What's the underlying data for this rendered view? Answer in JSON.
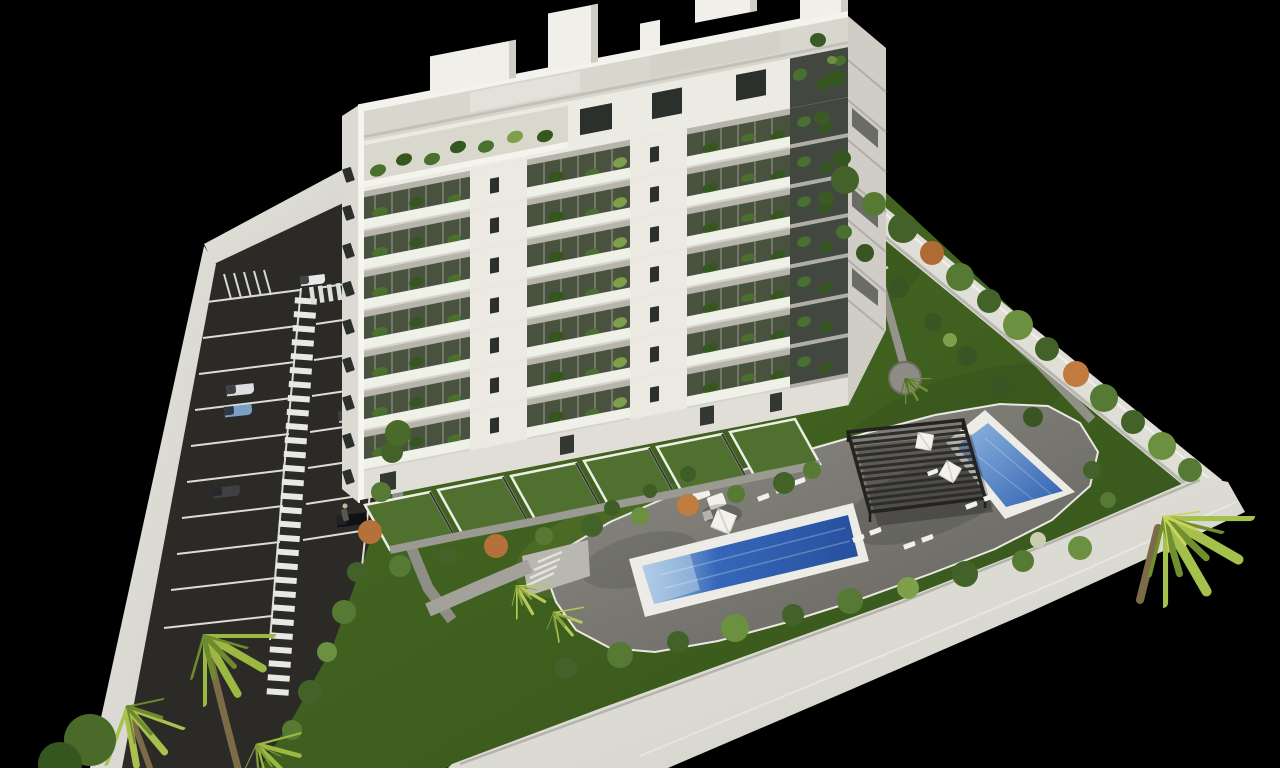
{
  "meta": {
    "description": "Aerial 3D architectural rendering: white multi-storey apartment building with balconies, rooftop terraces, landscaped garden, two blue swimming pools, slatted pergola, sun loungers, parasols, perimeter walls, palm trees and a striped parking lot, on a black background"
  },
  "colors": {
    "background": "#000000",
    "lawn": "#4c6d24",
    "lawn_dark": "#35541b",
    "asphalt": "#2b2a27",
    "marking": "#e6e6e2",
    "wall": "#dfded7",
    "wall_dark": "#bcbbb3",
    "deck_light": "#8d8c85",
    "deck_dark": "#63625c",
    "pool_rim": "#edebe5",
    "pool_water_light": "#a9c9e6",
    "pool_water": "#3567b8",
    "pool_water_deep": "#27509e",
    "pergola": "#2e2d29",
    "building_white": "#f1f0ea",
    "facade": "#e9e7e0",
    "facade_shadow": "#b6b4ab",
    "left_face": "#dbd9d1",
    "right_face": "#cfcdc5",
    "balcony_glass": "#49513f",
    "railing": "#eff0e8",
    "roof": "#d8d7ce",
    "window": "#2c302d",
    "terrace_green": "#507030",
    "plant": "#4a7030",
    "plant_dark": "#35571f",
    "plant_light": "#7fa04a",
    "plant_accent": "#b5713a",
    "palm": "#9ab842",
    "palm_dark": "#6d8a2c",
    "palm_pale": "#c9d45e",
    "trunk": "#7b6b47",
    "path": "#9a9992",
    "umbrella": "#f2f1eb",
    "furniture": "#f1f0ea"
  },
  "building": {
    "balcony_floor_count": 7,
    "balcony_sections_per_floor": 3,
    "penthouse_levels": 2,
    "left_face_window_count": 9,
    "roof_structures": 5
  },
  "parking": {
    "left_stall_rows": 10,
    "right_stall_rows": 8,
    "walkway_style": "zebra-striped",
    "cars": [
      {
        "label": "white-hatchback",
        "color": "#e8e8e8"
      },
      {
        "label": "black-sedan",
        "color": "#17181a"
      },
      {
        "label": "white-sedan",
        "color": "#dcdee0"
      },
      {
        "label": "light-blue-sedan",
        "color": "#7aa1c4"
      },
      {
        "label": "silver-sedan",
        "color": "#c9cbcd"
      },
      {
        "label": "dark-gray-sedan",
        "color": "#3f4041"
      },
      {
        "label": "black-sedan-2",
        "color": "#101112"
      },
      {
        "label": "white-van",
        "color": "#eceff1"
      }
    ]
  },
  "pools": [
    {
      "name": "main-lap-pool"
    },
    {
      "name": "small-pool"
    }
  ],
  "amenities": {
    "pergola_count": 1,
    "parasol_count": 3,
    "lounger_count": 12,
    "palm_tree_clusters": 5
  }
}
